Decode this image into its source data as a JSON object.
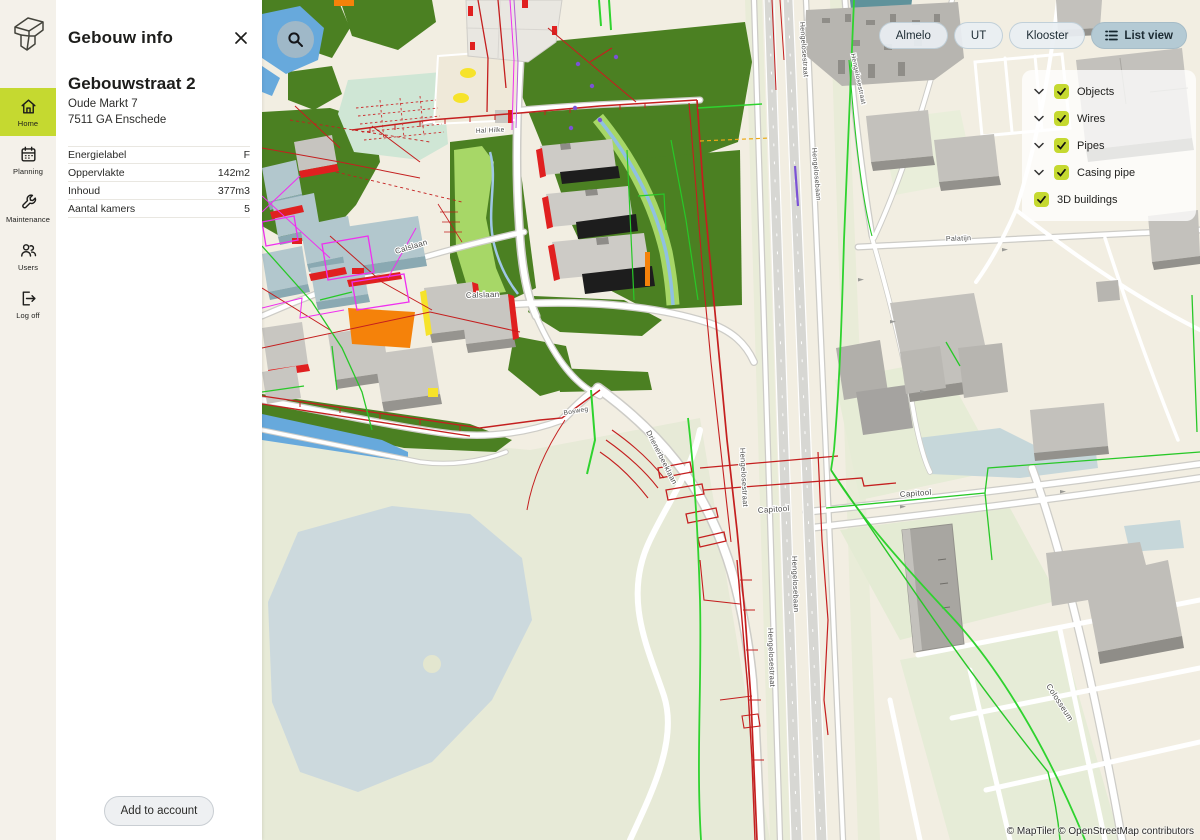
{
  "sidebar": {
    "items": [
      {
        "label": "Home",
        "icon": "home-icon",
        "active": true
      },
      {
        "label": "Planning",
        "icon": "calendar-icon",
        "active": false
      },
      {
        "label": "Maintenance",
        "icon": "wrench-icon",
        "active": false
      },
      {
        "label": "Users",
        "icon": "users-icon",
        "active": false
      },
      {
        "label": "Log off",
        "icon": "logout-icon",
        "active": false
      }
    ]
  },
  "info_panel": {
    "title": "Gebouw info",
    "building_name": "Gebouwstraat 2",
    "address_line1": "Oude Markt 7",
    "address_line2": "7511 GA Enschede",
    "details": [
      {
        "label": "Energielabel",
        "value": "F"
      },
      {
        "label": "Oppervlakte",
        "value": "142m2"
      },
      {
        "label": "Inhoud",
        "value": "377m3"
      },
      {
        "label": "Aantal kamers",
        "value": "5"
      }
    ],
    "action_label": "Add to account"
  },
  "map": {
    "location_buttons": [
      "Almelo",
      "UT",
      "Klooster"
    ],
    "list_view_label": "List view",
    "layers": [
      {
        "label": "Objects",
        "checked": true,
        "expandable": true
      },
      {
        "label": "Wires",
        "checked": true,
        "expandable": true
      },
      {
        "label": "Pipes",
        "checked": true,
        "expandable": true
      },
      {
        "label": "Casing pipe",
        "checked": true,
        "expandable": true
      },
      {
        "label": "3D buildings",
        "checked": true,
        "expandable": false
      }
    ],
    "labels": [
      {
        "text": "Hal Hilke"
      },
      {
        "text": "Calslaan"
      },
      {
        "text": "Calslaan"
      },
      {
        "text": "Bosweg"
      },
      {
        "text": "Drienerbeeklaan"
      },
      {
        "text": "Hengelosestraat"
      },
      {
        "text": "Hengelosebaan"
      },
      {
        "text": "Hengelosestraat"
      },
      {
        "text": "Hengelosestraat"
      },
      {
        "text": "Hengelosebaan"
      },
      {
        "text": "Hengelosestraat"
      },
      {
        "text": "Capitool"
      },
      {
        "text": "Capitool"
      },
      {
        "text": "Palatijn"
      },
      {
        "text": "Colosseum"
      }
    ],
    "attribution": "© MapTiler © OpenStreetMap contributors"
  },
  "colors": {
    "accent": "#c5d930",
    "sidebar_bg": "#f4f1ea",
    "panel_bg": "#ffffff",
    "listview_bg": "#b4cad4",
    "map_base": "#f2eee2",
    "map_forest": "#4b8022",
    "map_water": "#67a9dc",
    "wire_red": "#c41f1f",
    "pipe_green": "#2fd32f"
  }
}
